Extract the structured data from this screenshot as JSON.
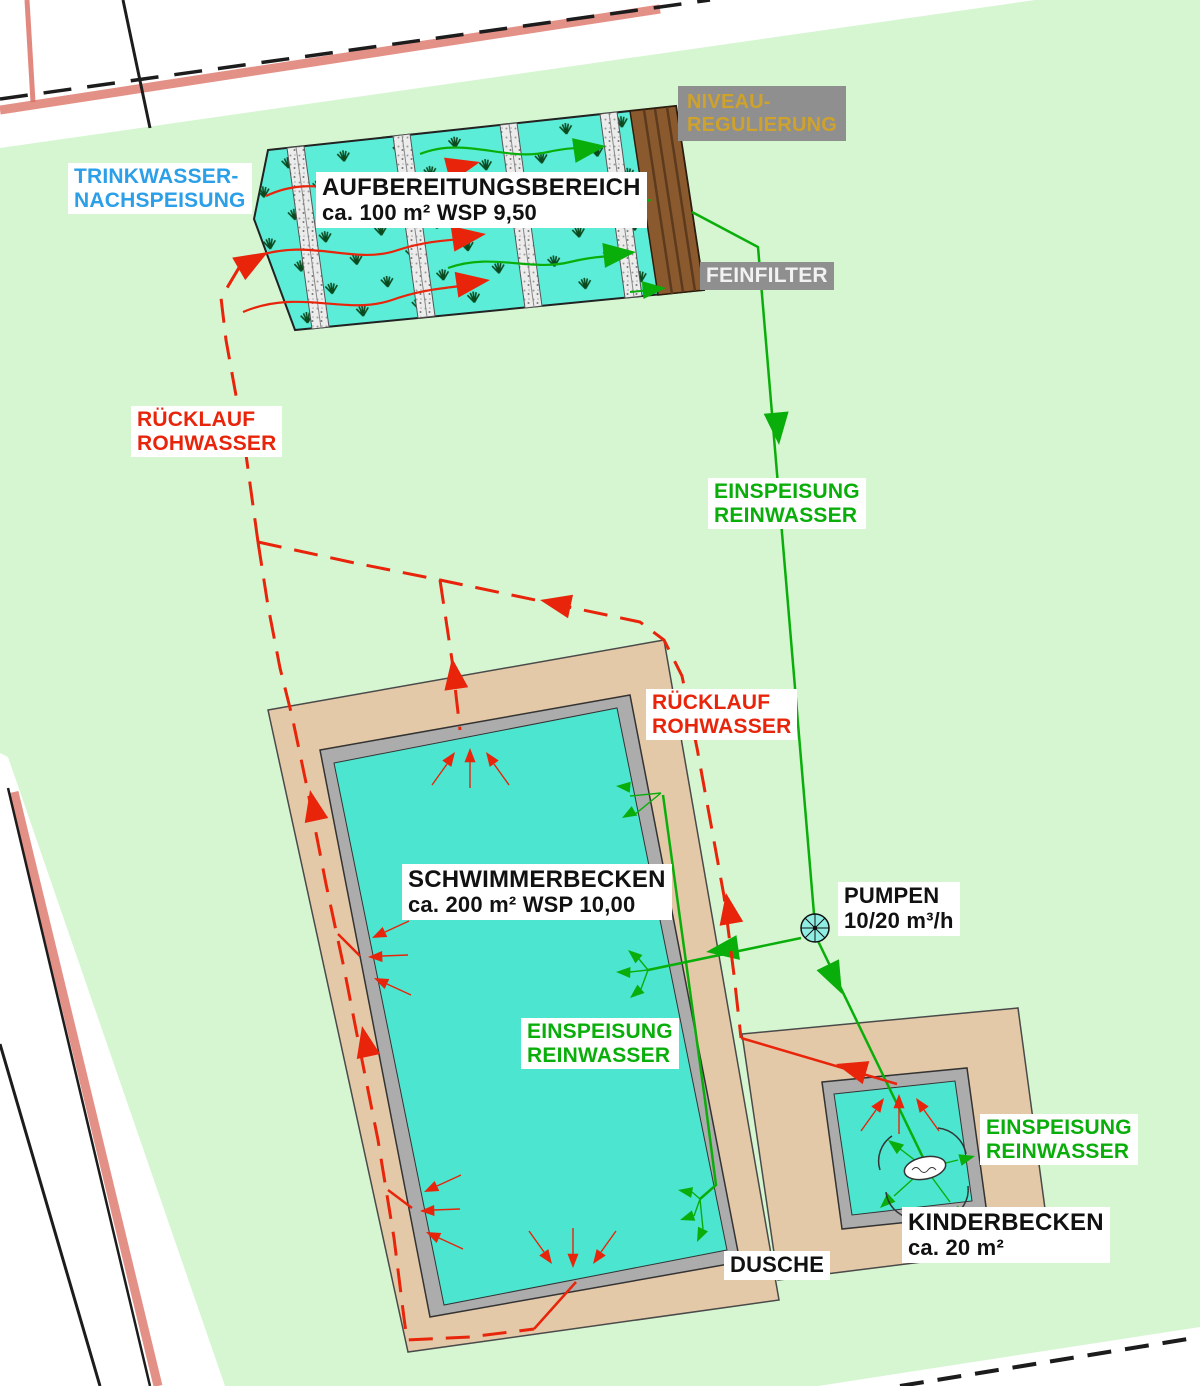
{
  "colors": {
    "site_green": "#D5F6D1",
    "water": "#4BE5D0",
    "bed_water": "#5CEDD8",
    "deck": "#E4C9A8",
    "pool_border": "#ACACAC",
    "flow_red": "#E8240A",
    "flow_green": "#0AAE0A",
    "label_blue": "#2B9FE8",
    "niveau_yellow": "#CFA22B",
    "box_gray": "#8F8F8F",
    "filter_brown": "#8A5A2E",
    "outline_dark": "#333333",
    "boundary_red": "#D96C5F",
    "boundary_black": "#1C1C1C",
    "gravel": "#ECECEC",
    "plant_green": "#0A4A1E"
  },
  "labels": {
    "trinkwasser": {
      "line1": "TRINKWASSER-",
      "line2": "NACHSPEISUNG"
    },
    "aufbereitung": {
      "line1": "AUFBEREITUNGSBEREICH",
      "line2": "ca. 100 m² WSP 9,50"
    },
    "niveau": {
      "line1": "NIVEAU-",
      "line2": "REGULIERUNG"
    },
    "feinfilter": {
      "line1": "FEINFILTER"
    },
    "ruecklauf_oben": {
      "line1": "RÜCKLAUF",
      "line2": "ROHWASSER"
    },
    "einspeisung_oben": {
      "line1": "EINSPEISUNG",
      "line2": "REINWASSER"
    },
    "ruecklauf_rechts": {
      "line1": "RÜCKLAUF",
      "line2": "ROHWASSER"
    },
    "schwimmerbecken": {
      "line1": "SCHWIMMERBECKEN",
      "line2": "ca. 200 m² WSP 10,00"
    },
    "pumpen": {
      "line1": "PUMPEN",
      "line2": "10/20 m³/h"
    },
    "einspeisung_mitte": {
      "line1": "EINSPEISUNG",
      "line2": "REINWASSER"
    },
    "einspeisung_kinder": {
      "line1": "EINSPEISUNG",
      "line2": "REINWASSER"
    },
    "kinderbecken": {
      "line1": "KINDERBECKEN",
      "line2": "ca. 20 m²"
    },
    "dusche": {
      "line1": "DUSCHE"
    }
  }
}
